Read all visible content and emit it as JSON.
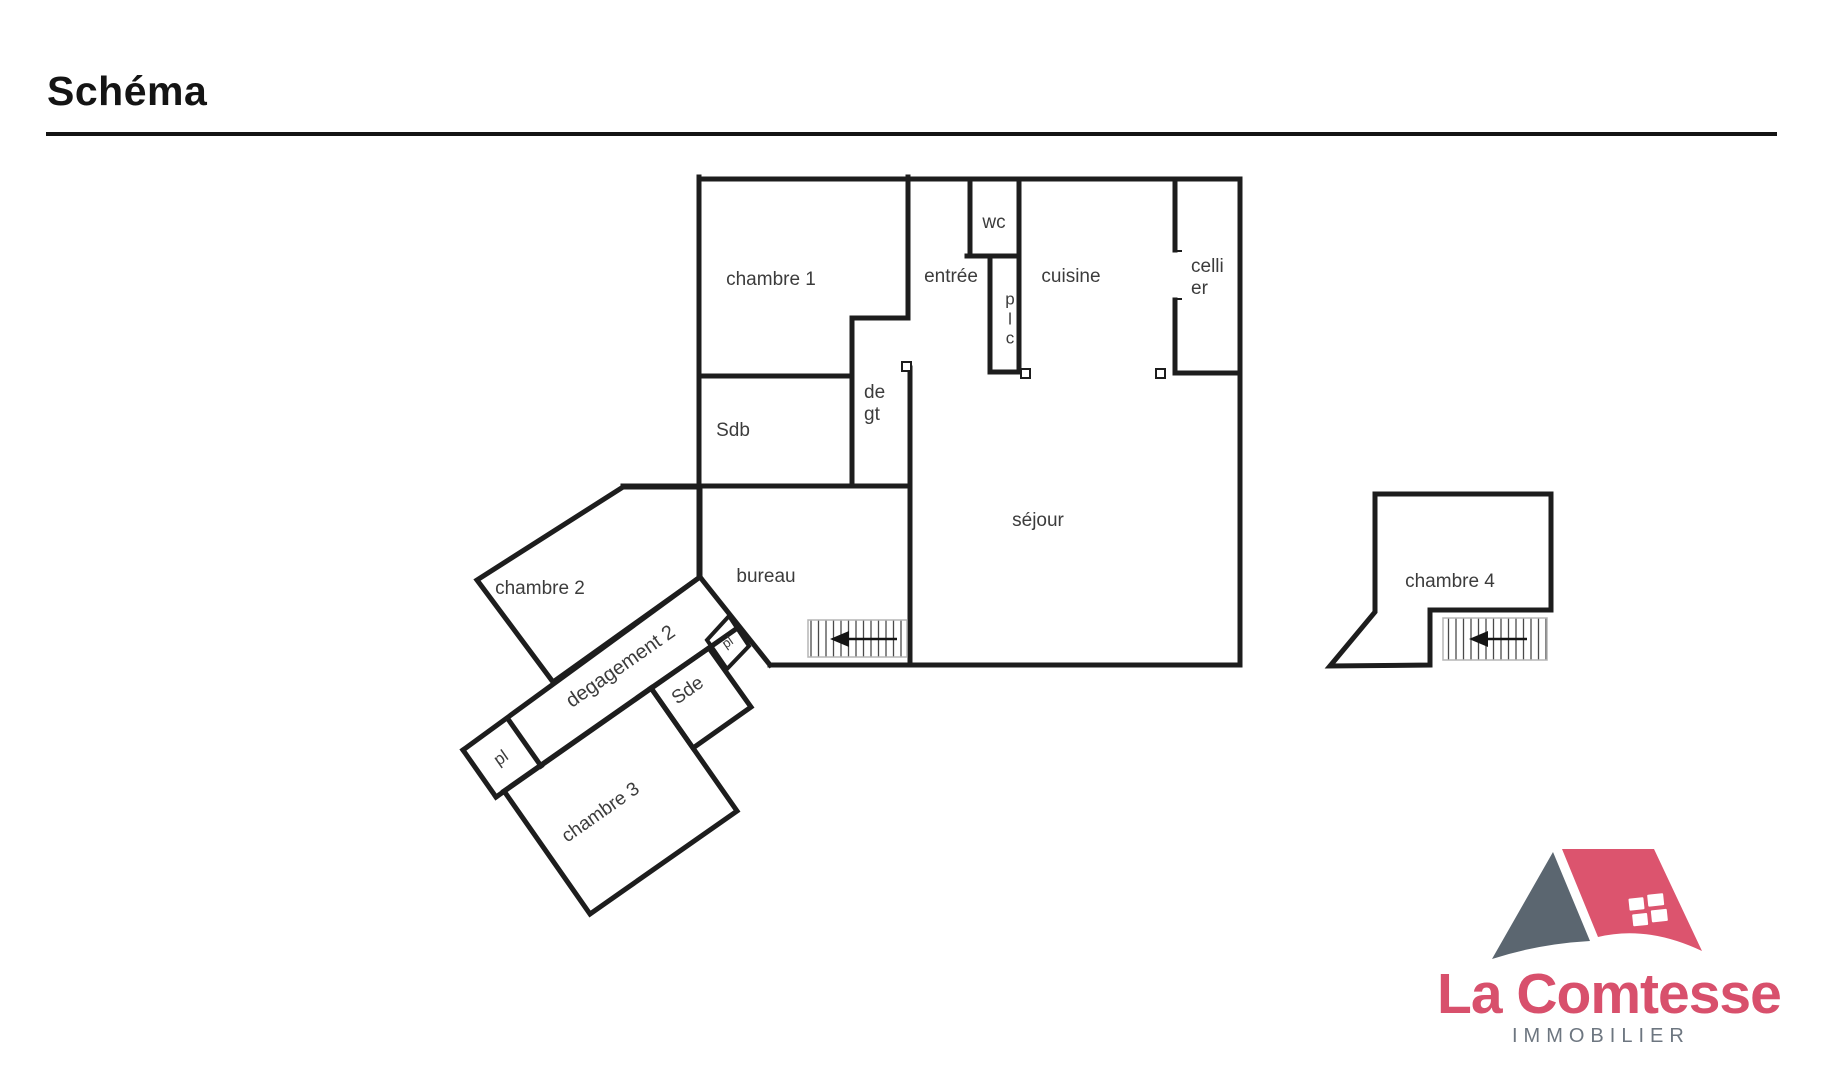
{
  "header": {
    "title": "Schéma"
  },
  "plan": {
    "rooms": [
      {
        "id": "chambre-1",
        "label": "chambre 1"
      },
      {
        "id": "entree",
        "label": "entrée"
      },
      {
        "id": "wc",
        "label": "wc"
      },
      {
        "id": "placard-plc",
        "label": "p\nl\nc"
      },
      {
        "id": "cuisine",
        "label": "cuisine"
      },
      {
        "id": "cellier",
        "label": "celli\ner"
      },
      {
        "id": "sdb",
        "label": "Sdb"
      },
      {
        "id": "degagement-1",
        "label": "de\ngt"
      },
      {
        "id": "sejour",
        "label": "séjour"
      },
      {
        "id": "bureau",
        "label": "bureau"
      },
      {
        "id": "chambre-2",
        "label": "chambre 2"
      },
      {
        "id": "degagement-2",
        "label": "degagement 2"
      },
      {
        "id": "sde",
        "label": "Sde"
      },
      {
        "id": "placard-pl-1",
        "label": "pl"
      },
      {
        "id": "placard-pl-2",
        "label": "pl"
      },
      {
        "id": "chambre-3",
        "label": "chambre 3"
      },
      {
        "id": "chambre-4",
        "label": "chambre 4"
      }
    ],
    "stairs": [
      {
        "location": "sejour",
        "arrow_direction": "left"
      },
      {
        "location": "chambre-4",
        "arrow_direction": "left"
      }
    ]
  },
  "colors": {
    "wall": "#1D1D1D",
    "label": "#3C3C3C",
    "background": "#FFFFFF"
  },
  "logo": {
    "brand": "La Comtesse",
    "tagline": "IMMOBILIER",
    "roof_color": "#DC546E",
    "gable_color": "#5B6670",
    "brand_color": "#D8506C",
    "tagline_color": "#6D7680"
  }
}
